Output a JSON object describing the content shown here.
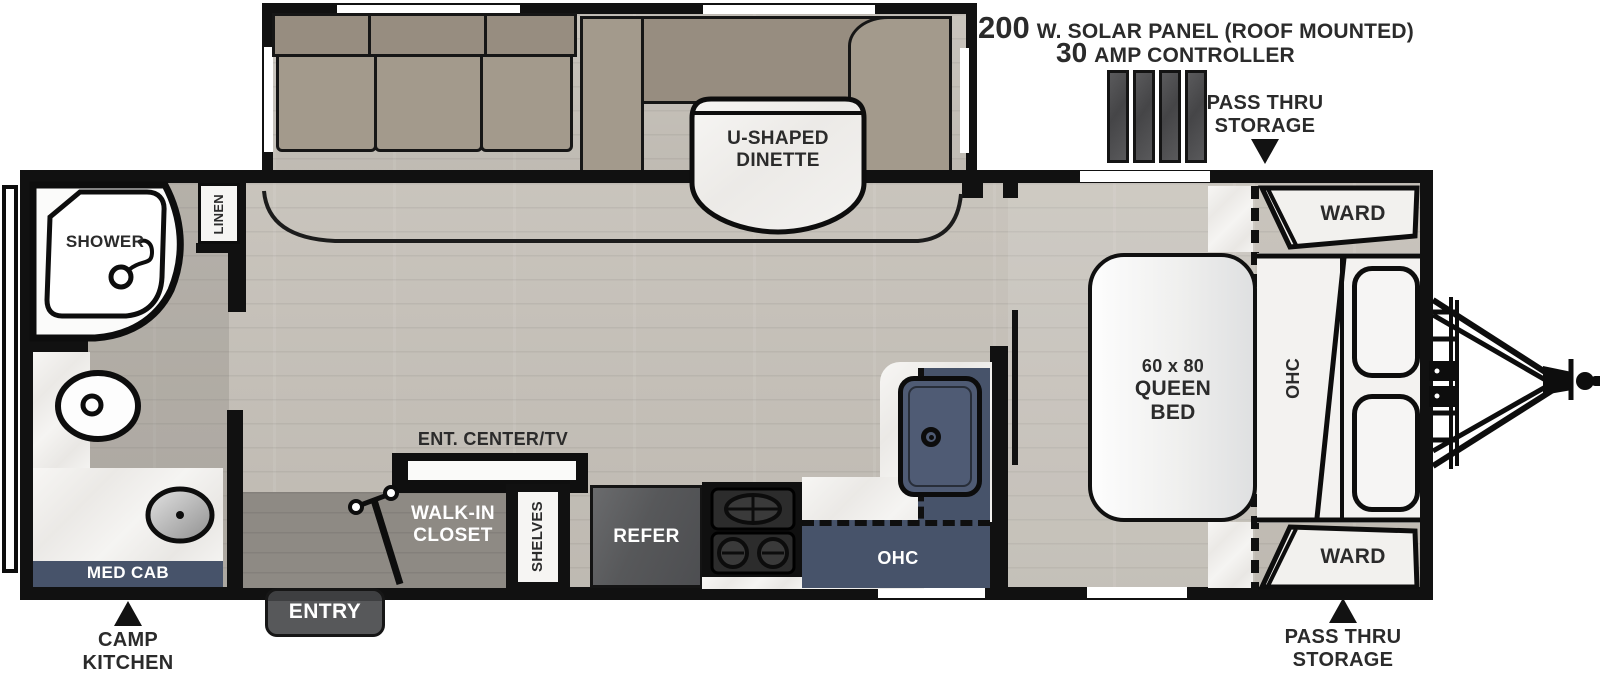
{
  "annotations": {
    "solar": {
      "value1": "200",
      "unit1": "W. SOLAR PANEL (ROOF MOUNTED)",
      "value2": "30",
      "unit2": "AMP CONTROLLER"
    },
    "pass_thru_top": {
      "line1": "PASS THRU",
      "line2": "STORAGE"
    },
    "pass_thru_bottom": {
      "line1": "PASS THRU",
      "line2": "STORAGE"
    },
    "camp_kitchen": {
      "line1": "CAMP",
      "line2": "KITCHEN"
    }
  },
  "rooms": {
    "shower": "SHOWER",
    "linen": "LINEN",
    "med_cab": "MED CAB",
    "entry": "ENTRY",
    "walk_in_closet": {
      "line1": "WALK-IN",
      "line2": "CLOSET"
    },
    "shelves": "SHELVES",
    "ent_center": "ENT. CENTER/TV",
    "refer": "REFER",
    "ohc_kitchen": "OHC",
    "ohc_bedroom": "OHC",
    "dinette": {
      "line1": "U-SHAPED",
      "line2": "DINETTE"
    },
    "queen_bed": {
      "line1": "60 x 80",
      "line2": "QUEEN",
      "line3": "BED"
    },
    "ward_top": "WARD",
    "ward_bottom": "WARD"
  },
  "colors": {
    "wall": "#111111",
    "navy_cabinet": "#47536a",
    "floor_wood": "#c6c1b9",
    "closet_floor": "#8e8a84",
    "cushion_taupe": "#a39a8c",
    "marble": "#f4f2f0",
    "appliance_gray": "#58595b",
    "bed_white": "#f4f4f3",
    "solar_panel": "#4e4e50"
  }
}
